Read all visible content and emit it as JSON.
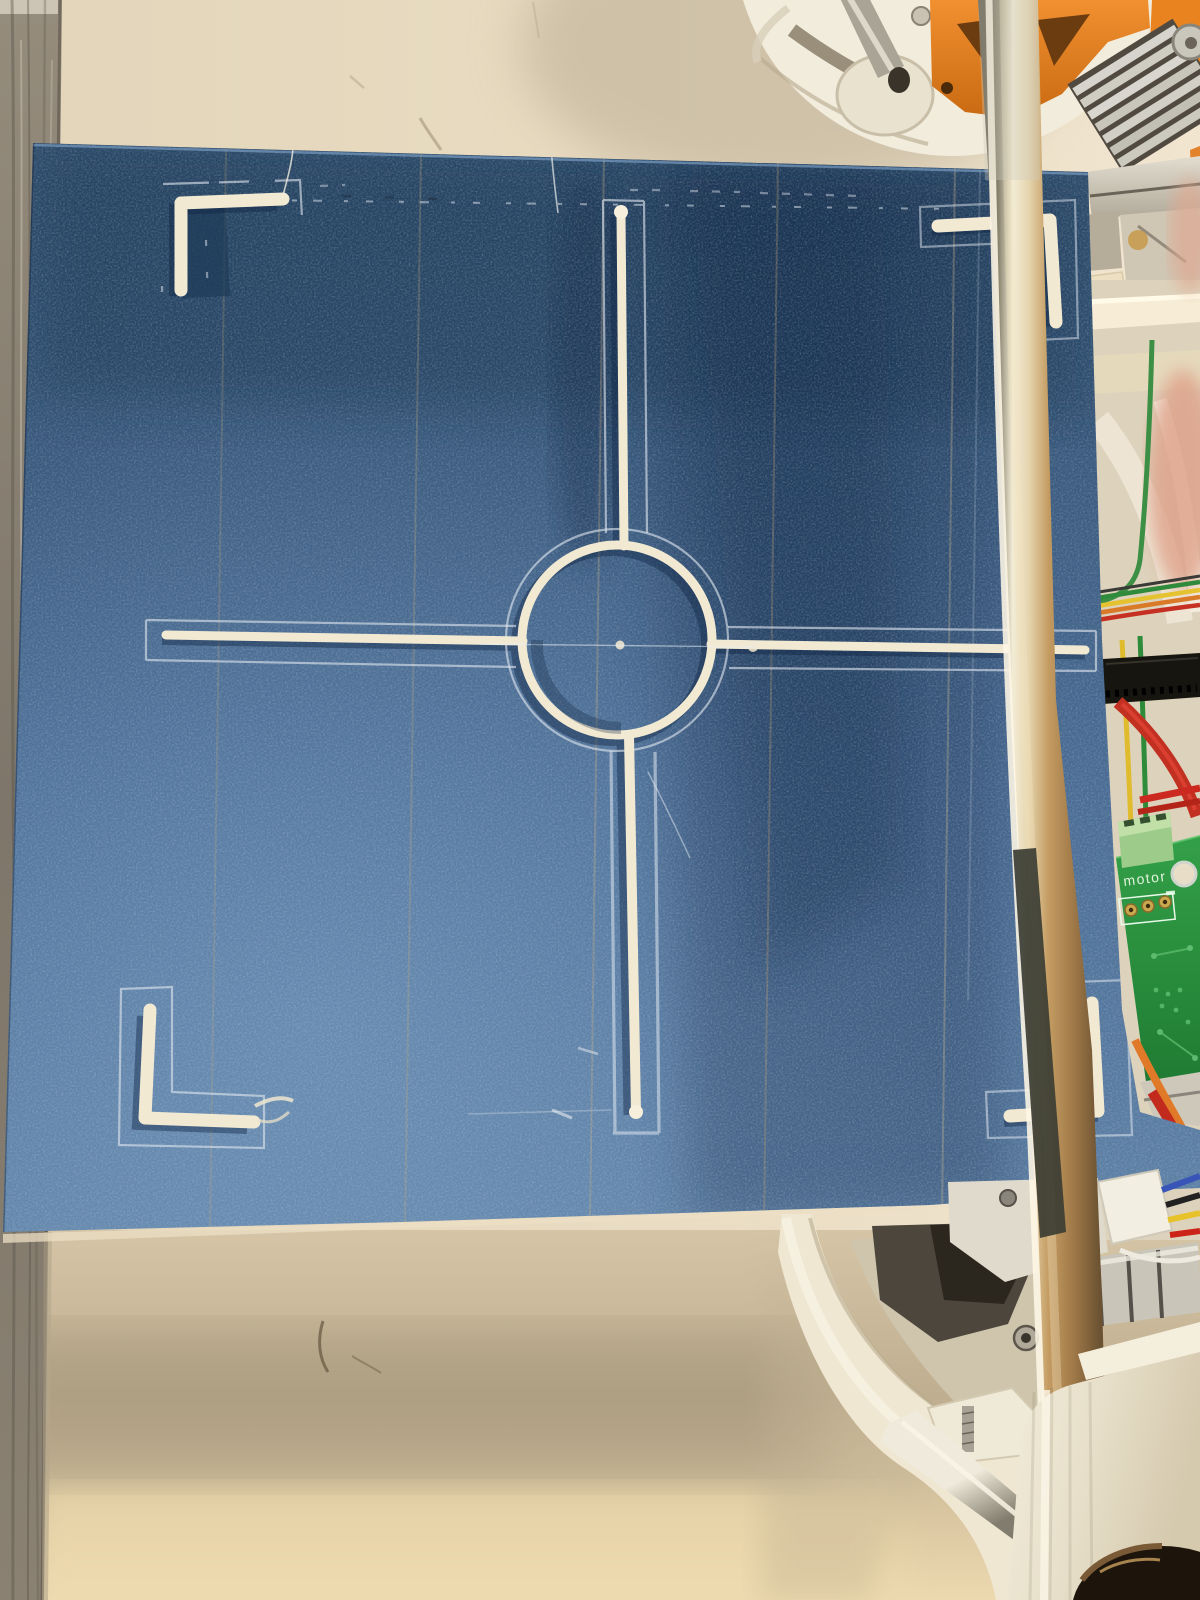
{
  "photo": {
    "subject": "3D printer print bed covered with blue painters tape, white filament calibration crosshair print, printer frame parts at right",
    "labels": {
      "motor_pcb": "motor"
    },
    "palette": {
      "tape_blue_mid": "#44618a",
      "tape_blue_dark": "#2c4a6e",
      "tape_blue_light": "#5e81a6",
      "filament_cream": "#f2e9d3",
      "skirt_line": "#dfe5ee",
      "wall_cream": "#e9dcc2",
      "table_cream": "#d9c9a9",
      "wood_gray": "#8a8172",
      "printed_part_orange": "#e8821f",
      "printed_part_white": "#f2ecdc",
      "pcb_green": "#2f9440",
      "terminal_green": "#a8cf92",
      "belt_black": "#16150f",
      "rod_brass": "#c59a5e",
      "wire_green": "#2e8b3a",
      "wire_yellow": "#e0bb2e",
      "wire_orange": "#d97a28",
      "wire_red": "#c23022",
      "wire_blue": "#3a55b8"
    },
    "print_pattern": {
      "center": "circle with four cross arms",
      "corners": "four L brackets with skirt outlines"
    }
  }
}
